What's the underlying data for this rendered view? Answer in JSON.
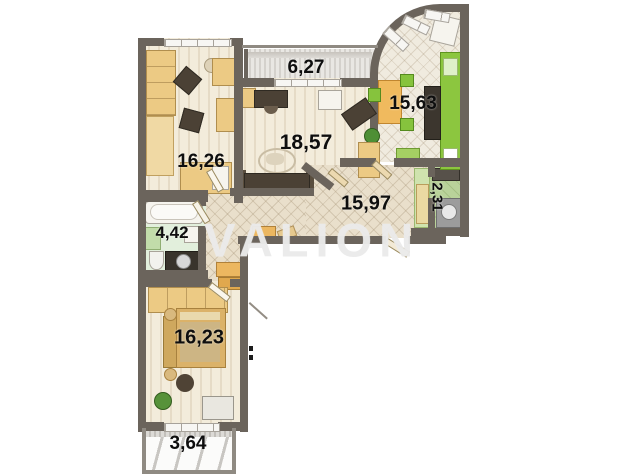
{
  "watermark": "VALION",
  "rooms": [
    {
      "key": "balcony-top",
      "area": "6,27"
    },
    {
      "key": "kitchen",
      "area": "15,63"
    },
    {
      "key": "living-room",
      "area": "18,57"
    },
    {
      "key": "room-top-left",
      "area": "16,26"
    },
    {
      "key": "storage",
      "area": "2,31"
    },
    {
      "key": "hallway",
      "area": "15,97"
    },
    {
      "key": "bathroom",
      "area": "4,42"
    },
    {
      "key": "bedroom",
      "area": "16,23"
    },
    {
      "key": "balcony-bottom",
      "area": "3,64"
    }
  ],
  "colors": {
    "wall": "#6b645c",
    "kitchen_green": "#8cc63f",
    "furniture_wood": "#ecca84",
    "floor_wood": "#f3ecdb",
    "floor_tile": "#e9dfcb",
    "bath_green": "#e2efdc",
    "storage_green": "#b9d29a",
    "label_text": "#0e0e0e",
    "watermark_gray": "#e9e9e9"
  }
}
